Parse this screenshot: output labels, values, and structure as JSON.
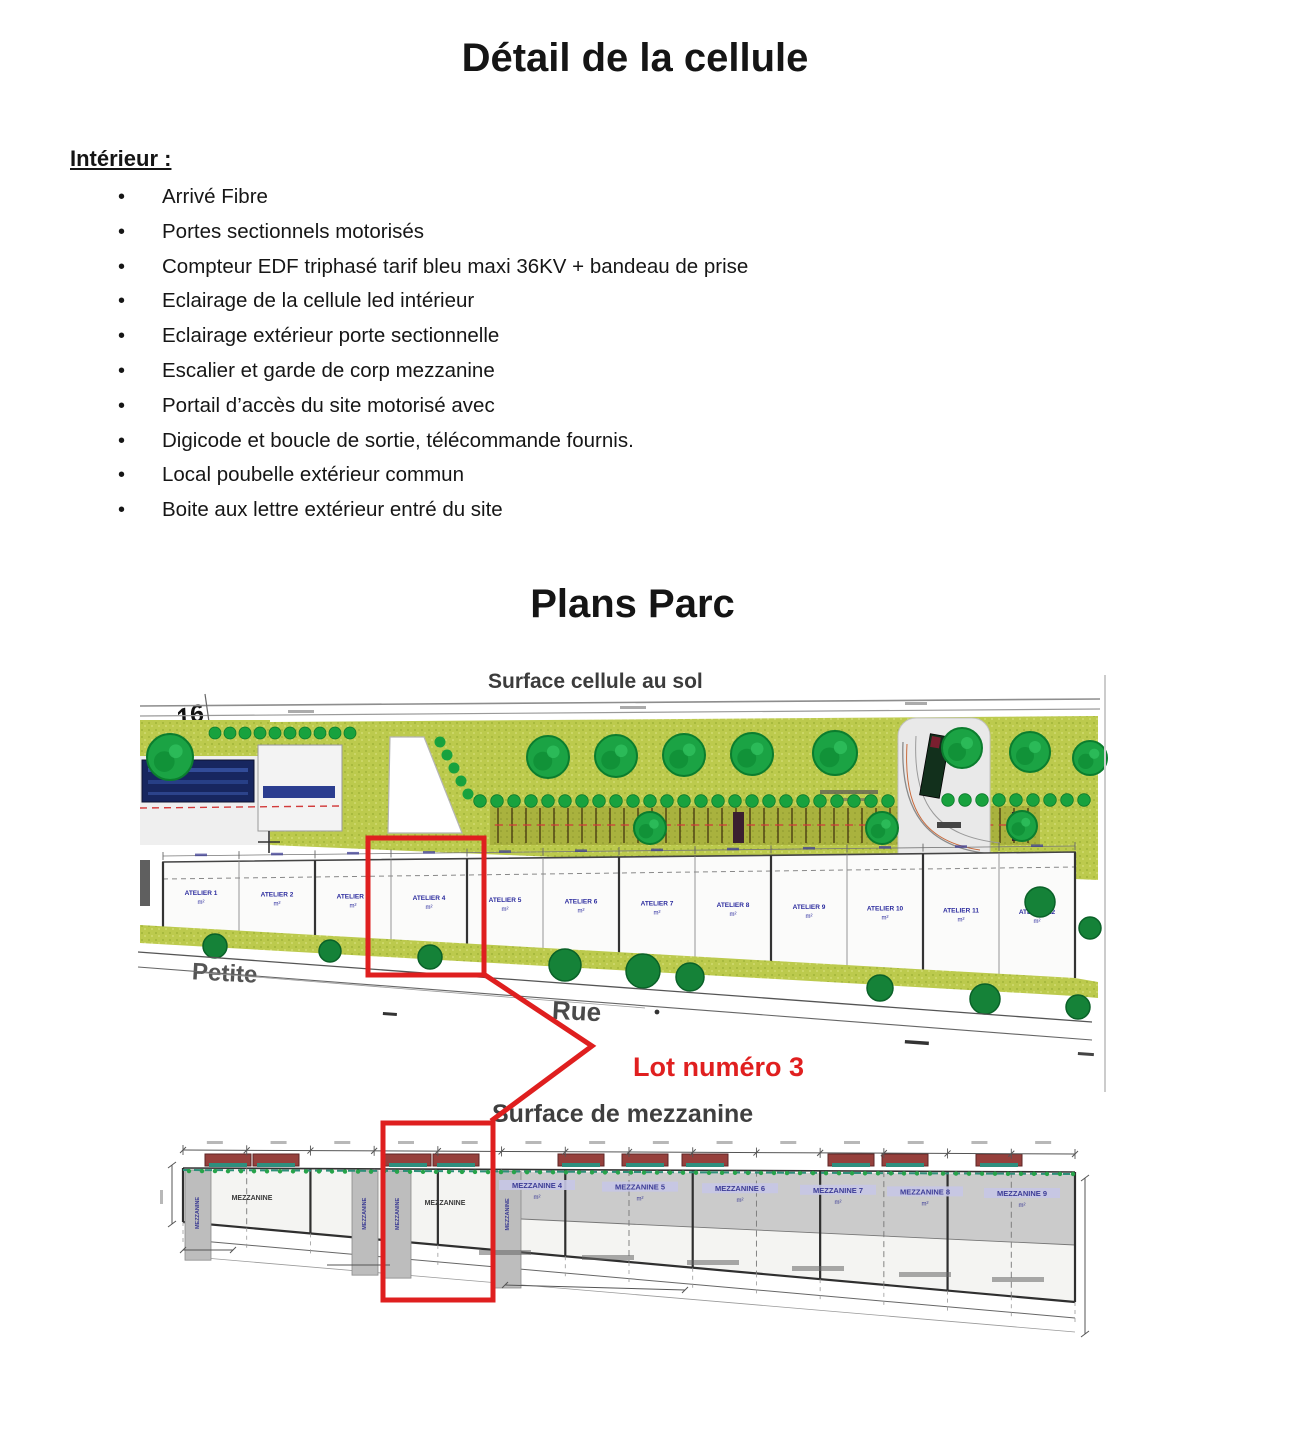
{
  "page": {
    "title": "Détail de la cellule",
    "section_heading": "Intérieur :",
    "bullets": [
      "Arrivé Fibre",
      "Portes sectionnels motorisés",
      "Compteur EDF triphasé tarif bleu maxi 36KV + bandeau de prise",
      "Eclairage de la cellule led intérieur",
      "Eclairage extérieur porte sectionnelle",
      "Escalier et garde de corp mezzanine",
      "Portail d’accès du site motorisé avec",
      "Digicode et boucle de sortie, télécommande fournis.",
      "Local poubelle extérieur commun",
      "Boite aux lettre extérieur entré du site"
    ],
    "plans_title": "Plans Parc"
  },
  "site_plan": {
    "label": "Surface cellule au sol",
    "watermark": "REALTY",
    "parcel_number": "16",
    "street_name_1": "Petite",
    "street_name_2": "Rue",
    "highlight_label": "Lot numéro 3",
    "atelier_label": "ATELIER",
    "area_suffix": "m²"
  },
  "mezzanine_plan": {
    "label": "Surface de mezzanine",
    "generic_label": "MEZZANINE",
    "cell_labels": [
      "MEZZANINE 4",
      "MEZZANINE 5",
      "MEZZANINE 6",
      "MEZZANINE 7",
      "MEZZANINE 8",
      "MEZZANINE 9"
    ],
    "area_suffix": "m²"
  },
  "colors": {
    "highlight_red": "#df1f1f",
    "grass_olive": "#bcca4d",
    "tree_green": "#1ba344",
    "navy_block": "#17265f",
    "label_blue": "#3c3c93",
    "mezz_grey": "#cbcbcb",
    "vent_red": "#96403c",
    "teal": "#2e8f7a"
  }
}
